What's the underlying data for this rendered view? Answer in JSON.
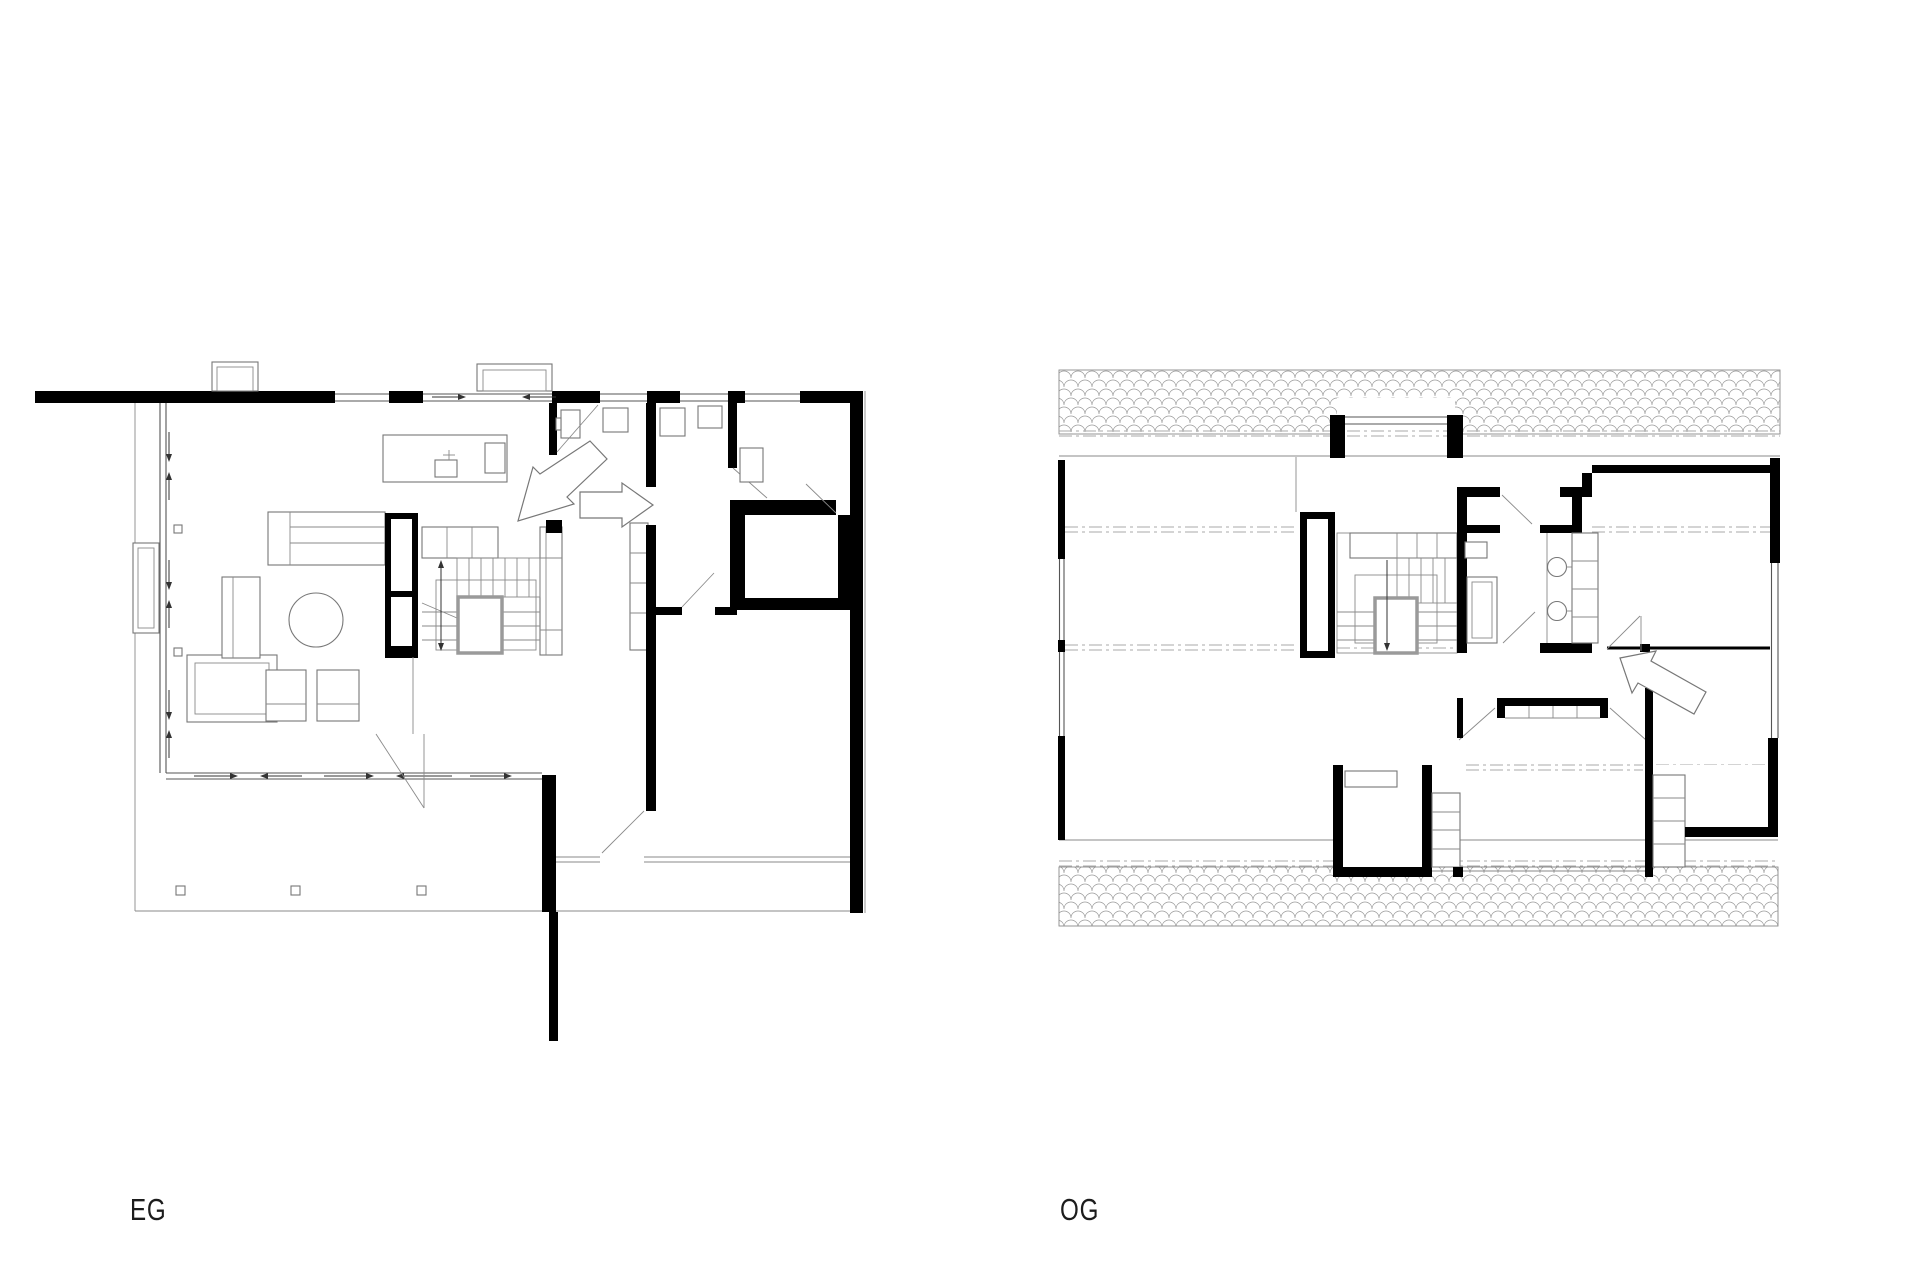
{
  "page": {
    "background": "#ffffff"
  },
  "plans": {
    "eg": {
      "label": "EG",
      "description": "ground floor plan (Erdgeschoss)"
    },
    "og": {
      "label": "OG",
      "description": "upper floor plan (Obergeschoss)"
    }
  },
  "colors": {
    "wall": "#000000",
    "thin_line": "#555555",
    "light_line": "#8a8a8a",
    "dash_line": "#aaaaaa",
    "roof_hatch": "#999999",
    "label_text": "#1c1c1c"
  }
}
